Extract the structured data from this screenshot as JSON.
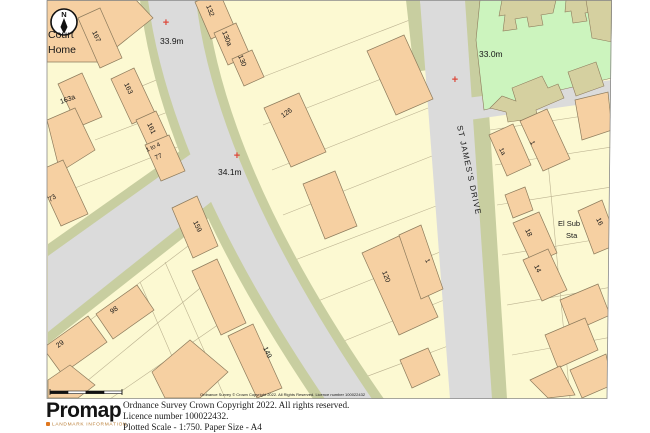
{
  "map": {
    "colors": {
      "cream": "#FCF9D2",
      "peach": "#F6D0A2",
      "road": "#DBDBDB",
      "verge": "#C8CEA0",
      "green": "#CCF4BE",
      "khaki": "#D5D0A0",
      "outline": "#8D7B5C",
      "red": "#DC4A3C",
      "parcel_line": "#B5AB8A"
    },
    "north_letter": "N",
    "labels": [
      {
        "text": "Court",
        "x": 48,
        "y": 38,
        "size": 10.5
      },
      {
        "text": "Home",
        "x": 48,
        "y": 53,
        "size": 10.5
      },
      {
        "text": "167",
        "x": 92,
        "y": 32,
        "rot": 65,
        "size": 7
      },
      {
        "text": "163a",
        "x": 61,
        "y": 104,
        "rot": -20,
        "size": 7
      },
      {
        "text": "163",
        "x": 124,
        "y": 84,
        "rot": 65,
        "size": 7
      },
      {
        "text": "161",
        "x": 147,
        "y": 124,
        "rot": 65,
        "size": 7
      },
      {
        "text": "1 to 4",
        "x": 147,
        "y": 152,
        "rot": -25,
        "size": 6
      },
      {
        "text": "77",
        "x": 156,
        "y": 160,
        "rot": -25,
        "size": 6.5
      },
      {
        "text": "73",
        "x": 50,
        "y": 202,
        "rot": -32,
        "size": 7
      },
      {
        "text": "98",
        "x": 112,
        "y": 314,
        "rot": -35,
        "size": 7
      },
      {
        "text": "29",
        "x": 58,
        "y": 348,
        "rot": -35,
        "size": 7
      },
      {
        "text": "132",
        "x": 206,
        "y": 6,
        "rot": 68,
        "size": 7
      },
      {
        "text": "130a",
        "x": 222,
        "y": 32,
        "rot": 68,
        "size": 7
      },
      {
        "text": "130",
        "x": 238,
        "y": 56,
        "rot": 68,
        "size": 7
      },
      {
        "text": "126",
        "x": 283,
        "y": 118,
        "rot": -35,
        "size": 7
      },
      {
        "text": "159",
        "x": 193,
        "y": 222,
        "rot": 65,
        "size": 7
      },
      {
        "text": "149",
        "x": 263,
        "y": 348,
        "rot": 65,
        "size": 7
      },
      {
        "text": "120",
        "x": 382,
        "y": 272,
        "rot": 68,
        "size": 7
      },
      {
        "text": "1",
        "x": 425,
        "y": 260,
        "rot": 65,
        "size": 6.5
      },
      {
        "text": "1a",
        "x": 499,
        "y": 149,
        "rot": 65,
        "size": 6.5
      },
      {
        "text": "1",
        "x": 530,
        "y": 142,
        "rot": 65,
        "size": 6.5
      },
      {
        "text": "El Sub",
        "x": 558,
        "y": 226,
        "size": 7.5
      },
      {
        "text": "Sta",
        "x": 566,
        "y": 238,
        "size": 7.5
      },
      {
        "text": "16",
        "x": 596,
        "y": 219,
        "rot": 65,
        "size": 7
      },
      {
        "text": "18",
        "x": 525,
        "y": 230,
        "rot": 65,
        "size": 7
      },
      {
        "text": "14",
        "x": 534,
        "y": 266,
        "rot": 65,
        "size": 7
      },
      {
        "text": "33.9m",
        "x": 160,
        "y": 44,
        "size": 8.5
      },
      {
        "text": "34.1m",
        "x": 218,
        "y": 175,
        "size": 8.5
      },
      {
        "text": "33.0m",
        "x": 479,
        "y": 57,
        "size": 8.5
      },
      {
        "text": "ST JAMES'S DRIVE",
        "x": 457,
        "y": 126,
        "rot": 78,
        "size": 8,
        "spacing": 1.2
      },
      {
        "text": "Ordnance Survey © Crown Copyright 2022. All Rights Reserved. Licence number 100022432",
        "x": 200,
        "y": 396,
        "size": 4
      }
    ],
    "crosses": [
      {
        "x": 166,
        "y": 22
      },
      {
        "x": 237,
        "y": 155
      },
      {
        "x": 455,
        "y": 79
      }
    ]
  },
  "footer": {
    "logo_text": "Promap",
    "logo_subtext": "LANDMARK INFORMATION",
    "line1": "Ordnance Survey Crown Copyright 2022. All rights reserved.",
    "line2": "Licence number 100022432.",
    "line3": "Plotted Scale - 1:750. Paper Size - A4"
  }
}
